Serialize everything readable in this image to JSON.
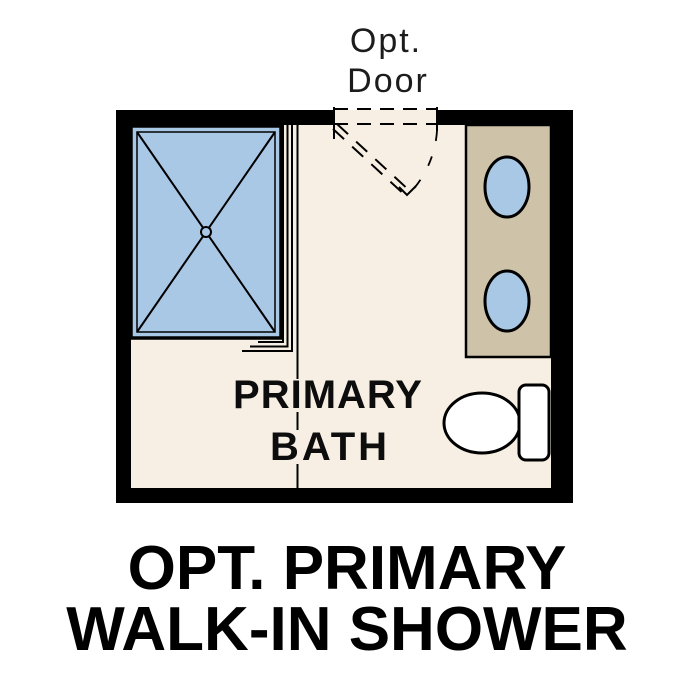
{
  "opt_door_label": {
    "line1": "Opt.",
    "line2": "Door"
  },
  "room_label": {
    "line1": "PRIMARY",
    "line2": "BATH"
  },
  "caption": {
    "line1": "OPT. PRIMARY",
    "line2": "WALK-IN SHOWER"
  },
  "colors": {
    "background": "#ffffff",
    "wall": "#000000",
    "floor": "#f7efe3",
    "shower_pan": "#a9c8e6",
    "sink": "#a9c8e6",
    "vanity": "#cec2a9",
    "fixture_white": "#ffffff",
    "line": "#000000",
    "note_text": "#1c1c1c",
    "room_text": "#0d0d0d",
    "caption_text": "#000000"
  }
}
